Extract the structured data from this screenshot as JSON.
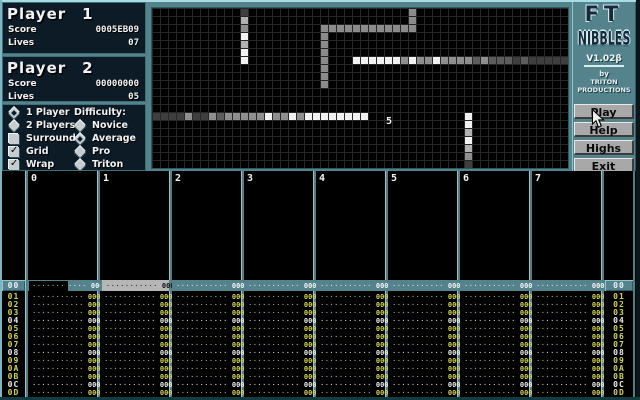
{
  "player1": {
    "name": "Player",
    "number": "1",
    "score_label": "Score",
    "score": "0005EB09",
    "lives_label": "Lives",
    "lives": "07"
  },
  "player2": {
    "name": "Player",
    "number": "2",
    "score_label": "Score",
    "score": "00000000",
    "lives_label": "Lives",
    "lives": "05"
  },
  "options": {
    "player_modes": [
      {
        "label": "1 Player",
        "selected": true
      },
      {
        "label": "2 Players",
        "selected": false
      }
    ],
    "checkboxes": [
      {
        "label": "Surround",
        "checked": false
      },
      {
        "label": "Grid",
        "checked": true
      },
      {
        "label": "Wrap",
        "checked": true
      }
    ],
    "difficulty_label": "Difficulty:",
    "difficulty": [
      {
        "label": "Novice",
        "selected": false
      },
      {
        "label": "Average",
        "selected": true
      },
      {
        "label": "Pro",
        "selected": false
      },
      {
        "label": "Triton",
        "selected": false
      }
    ]
  },
  "logo": {
    "line1": "FT",
    "line2": "NIBBLES",
    "version": "V1.02β",
    "by": "by",
    "studio_line1": "TRITON",
    "studio_line2": "PRODUCTIONS"
  },
  "buttons": [
    {
      "label": "Play"
    },
    {
      "label": "Help"
    },
    {
      "label": "Highs"
    },
    {
      "label": "Exit"
    }
  ],
  "game_field": {
    "cols": 52,
    "rows": 20,
    "cell_px": 8,
    "food": {
      "value": "5",
      "col": 29,
      "row": 13
    },
    "wall_color": "#8a8a8a",
    "palette": {
      "w": "#f2f2f2",
      "lg": "#b2b2b2",
      "g": "#8e8e8e",
      "dg": "#5c5c5c",
      "d": "#3e3e3e"
    },
    "walls": [
      [
        21,
        2
      ],
      [
        22,
        2
      ],
      [
        23,
        2
      ],
      [
        24,
        2
      ],
      [
        25,
        2
      ],
      [
        26,
        2
      ],
      [
        27,
        2
      ],
      [
        28,
        2
      ],
      [
        29,
        2
      ],
      [
        30,
        2
      ],
      [
        31,
        2
      ],
      [
        32,
        2
      ],
      [
        21,
        3
      ],
      [
        21,
        4
      ],
      [
        21,
        5
      ],
      [
        21,
        6
      ],
      [
        21,
        7
      ],
      [
        21,
        8
      ],
      [
        21,
        9
      ],
      [
        32,
        0
      ],
      [
        32,
        1
      ]
    ],
    "snakes": [
      {
        "cells": [
          [
            11,
            0,
            "d"
          ],
          [
            11,
            1,
            "lg"
          ],
          [
            11,
            2,
            "g"
          ],
          [
            11,
            3,
            "w"
          ],
          [
            11,
            4,
            "lg"
          ],
          [
            11,
            5,
            "w"
          ],
          [
            11,
            6,
            "w"
          ]
        ]
      },
      {
        "cells": [
          [
            25,
            6,
            "w"
          ],
          [
            26,
            6,
            "w"
          ],
          [
            27,
            6,
            "w"
          ],
          [
            28,
            6,
            "w"
          ],
          [
            29,
            6,
            "w"
          ],
          [
            30,
            6,
            "w"
          ],
          [
            31,
            6,
            "g"
          ],
          [
            32,
            6,
            "w"
          ],
          [
            33,
            6,
            "g"
          ],
          [
            34,
            6,
            "g"
          ],
          [
            35,
            6,
            "w"
          ],
          [
            36,
            6,
            "g"
          ],
          [
            37,
            6,
            "g"
          ],
          [
            38,
            6,
            "g"
          ],
          [
            39,
            6,
            "g"
          ],
          [
            40,
            6,
            "dg"
          ],
          [
            41,
            6,
            "g"
          ],
          [
            42,
            6,
            "dg"
          ],
          [
            43,
            6,
            "dg"
          ],
          [
            44,
            6,
            "dg"
          ],
          [
            45,
            6,
            "d"
          ],
          [
            46,
            6,
            "dg"
          ],
          [
            47,
            6,
            "d"
          ],
          [
            48,
            6,
            "d"
          ],
          [
            49,
            6,
            "d"
          ],
          [
            50,
            6,
            "d"
          ],
          [
            51,
            6,
            "d"
          ]
        ]
      },
      {
        "cells": [
          [
            0,
            13,
            "d"
          ],
          [
            1,
            13,
            "d"
          ],
          [
            2,
            13,
            "d"
          ],
          [
            3,
            13,
            "d"
          ],
          [
            4,
            13,
            "g"
          ],
          [
            5,
            13,
            "d"
          ],
          [
            6,
            13,
            "d"
          ],
          [
            7,
            13,
            "g"
          ],
          [
            8,
            13,
            "dg"
          ],
          [
            9,
            13,
            "g"
          ],
          [
            10,
            13,
            "g"
          ],
          [
            11,
            13,
            "g"
          ],
          [
            12,
            13,
            "g"
          ],
          [
            13,
            13,
            "g"
          ],
          [
            14,
            13,
            "w"
          ],
          [
            15,
            13,
            "g"
          ],
          [
            16,
            13,
            "g"
          ],
          [
            17,
            13,
            "w"
          ],
          [
            18,
            13,
            "g"
          ],
          [
            19,
            13,
            "w"
          ],
          [
            20,
            13,
            "w"
          ],
          [
            21,
            13,
            "w"
          ],
          [
            22,
            13,
            "w"
          ],
          [
            23,
            13,
            "w"
          ],
          [
            24,
            13,
            "w"
          ],
          [
            25,
            13,
            "w"
          ],
          [
            26,
            13,
            "w"
          ]
        ]
      },
      {
        "cells": [
          [
            39,
            13,
            "w"
          ],
          [
            39,
            14,
            "w"
          ],
          [
            39,
            15,
            "lg"
          ],
          [
            39,
            16,
            "w"
          ],
          [
            39,
            17,
            "lg"
          ],
          [
            39,
            18,
            "g"
          ],
          [
            39,
            19,
            "d"
          ]
        ]
      }
    ]
  },
  "pattern": {
    "channels": [
      "0",
      "1",
      "2",
      "3",
      "4",
      "5",
      "6",
      "7"
    ],
    "current_row": "00",
    "rows": [
      "01",
      "02",
      "03",
      "04",
      "05",
      "06",
      "07",
      "08",
      "09",
      "0A",
      "0B",
      "0C",
      "0D"
    ],
    "highlight_rows": [
      "04",
      "08",
      "0C"
    ],
    "cell": {
      "note_dots": "·······",
      "vol_dots": "····",
      "effect": "000"
    }
  },
  "colors": {
    "desktop_teal": "#54838c",
    "bevel_light": "#a8dde6",
    "bevel_dark": "#2a5a63",
    "panel_navy": "#0c1b26",
    "pattern_yellow": "#d2d25a",
    "pattern_highlight": "#ededed",
    "marked_block": "#b6b6b6",
    "button_gray": "#a8a8a8"
  }
}
